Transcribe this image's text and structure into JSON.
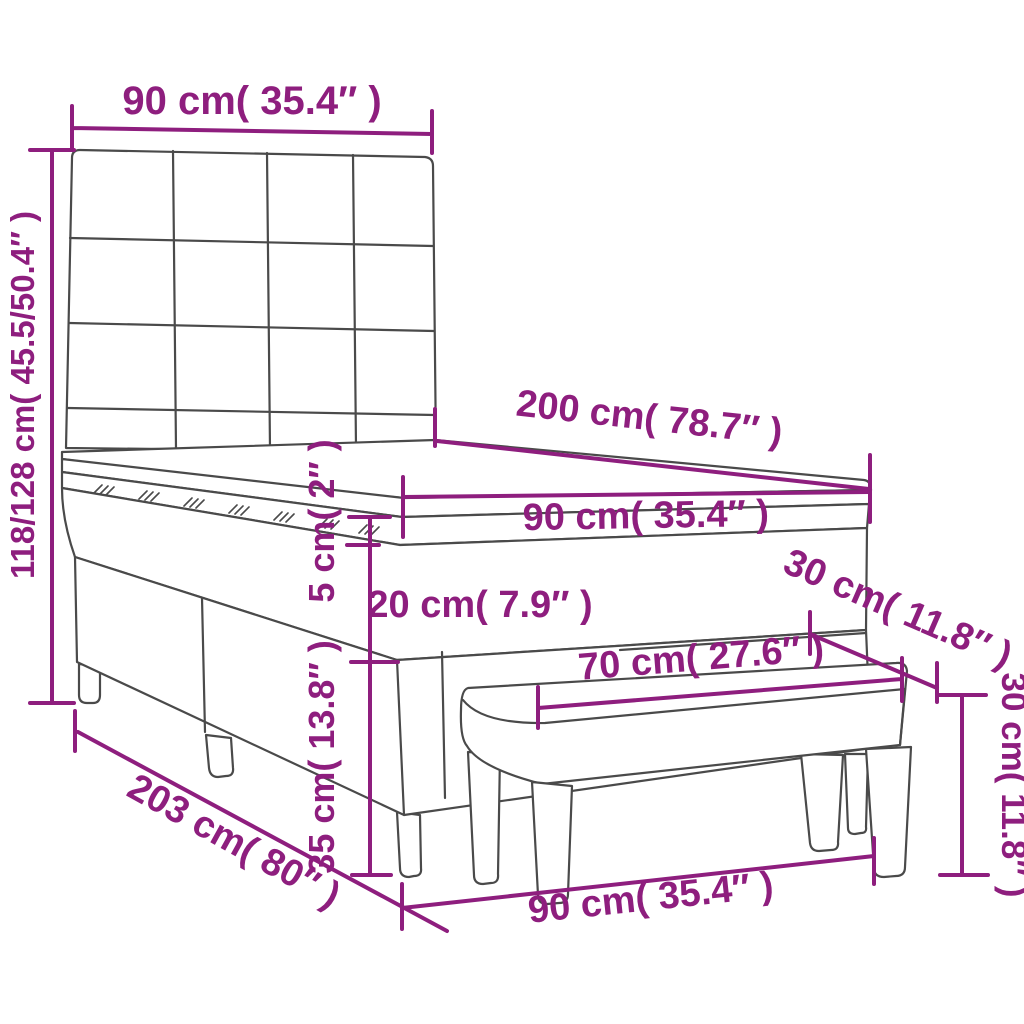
{
  "title": "Box spring bed with topper, headboard and bench — dimension diagram",
  "colors": {
    "dimension_accent": "#8E1E7E",
    "drawing_line": "#4A4A4A",
    "background": "#FFFFFF"
  },
  "dimensions": {
    "headboard_width": "90 cm( 35.4″ )",
    "total_height": "118/128 cm( 45.5/50.4″ )",
    "bed_length": "200 cm( 78.7″ )",
    "mattress_width": "90 cm( 35.4″ )",
    "topper_thickness": "5 cm( 2″ )",
    "mattress_thickness": "20 cm( 7.9″ )",
    "base_height": "35 cm( 13.8″ )",
    "total_length": "203 cm( 80″ )",
    "bed_width_bottom": "90 cm( 35.4″ )",
    "bench_length": "70 cm( 27.6″ )",
    "bench_depth": "30 cm( 11.8″ )",
    "bench_height": "30 cm( 11.8″ )"
  }
}
